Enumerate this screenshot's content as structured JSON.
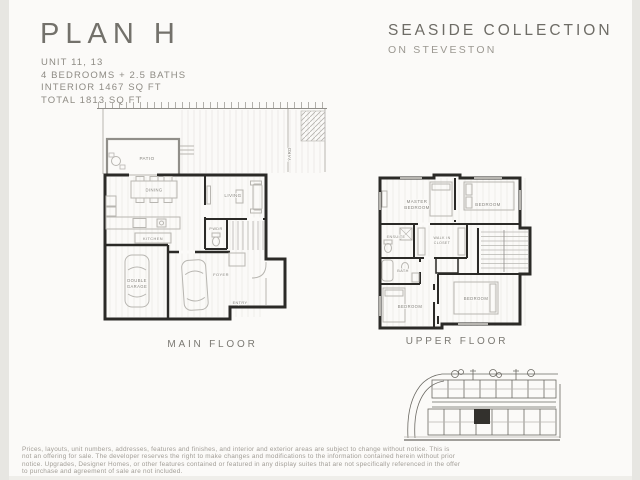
{
  "header": {
    "plan_title": "PLAN H",
    "details": [
      "UNIT 11, 13",
      "4 BEDROOMS + 2.5 BATHS",
      "INTERIOR 1467 SQ FT",
      "TOTAL 1813 SQ FT"
    ],
    "collection_title": "SEASIDE COLLECTION",
    "collection_subtitle": "ON STEVESTON"
  },
  "main_floor": {
    "caption": "MAIN FLOOR",
    "labels": {
      "patio": "PATIO",
      "yard": "YARD",
      "dining": "DINING",
      "kitchen": "KITCHEN",
      "living": "LIVING",
      "powder": "PWDR",
      "garage_line1": "DOUBLE",
      "garage_line2": "GARAGE",
      "foyer": "FOYER",
      "entry": "ENTRY"
    }
  },
  "upper_floor": {
    "caption": "UPPER FLOOR",
    "labels": {
      "master_line1": "MASTER",
      "master_line2": "BEDROOM",
      "bedroom_top_right": "BEDROOM",
      "ensuite": "ENSUITE",
      "wic_line1": "WALK IN",
      "wic_line2": "CLOSET",
      "bath": "BATH",
      "bedroom_bottom_left": "BEDROOM",
      "bedroom_bottom_right": "BEDROOM"
    }
  },
  "disclaimer": {
    "lines": [
      "Prices, layouts, unit numbers, addresses, features and finishes, and interior and exterior areas are subject to change without notice. This is",
      "not an offering for sale. The developer reserves the right to make changes and modifications to the information contained herein without prior",
      "notice. Upgrades, Designer Homes, or other features contained or featured in any display suites that are not specifically referenced in the offer",
      "to purchase and agreement of sale are not included."
    ]
  },
  "colors": {
    "wall_color": "#2b2a27",
    "heading_color": "#73716b",
    "label_color": "#85837d",
    "page_bg": "#fbfaf8"
  }
}
